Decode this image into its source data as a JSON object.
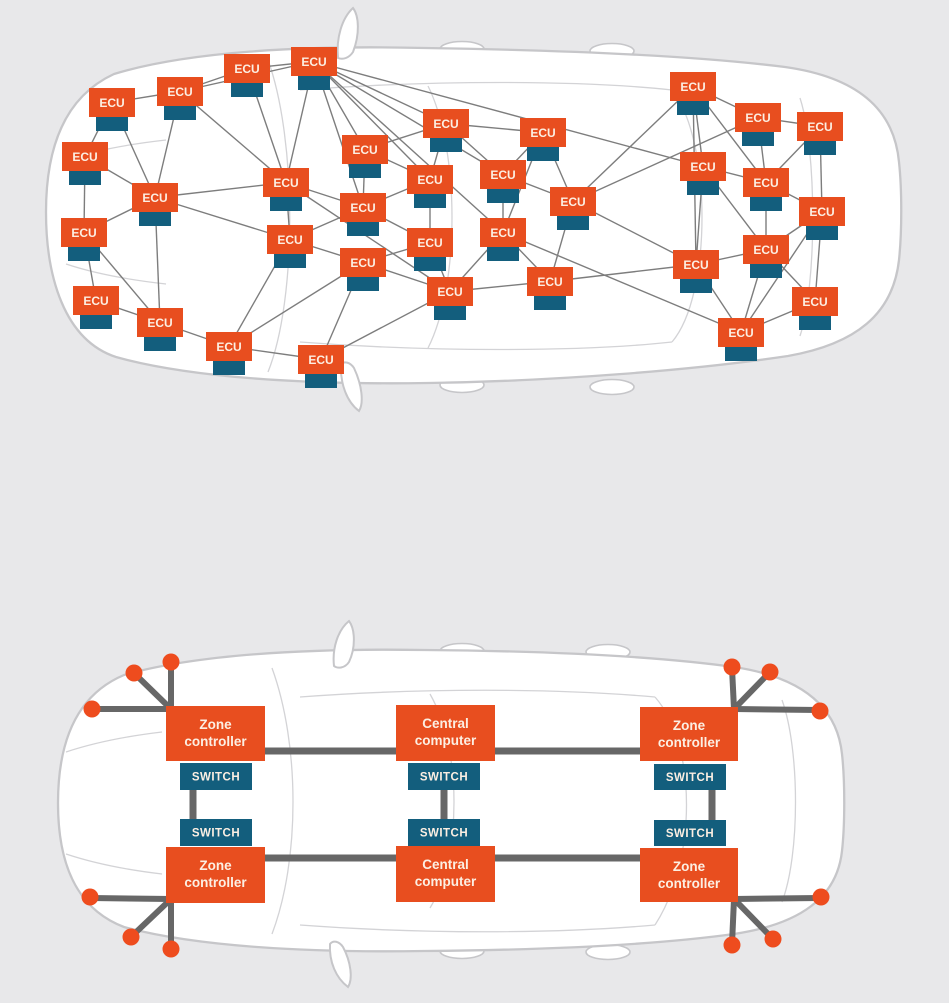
{
  "colors": {
    "background": "#e8e8ea",
    "box_orange": "#e84e1f",
    "box_teal": "#135e7d",
    "dot_orange": "#ee4c1e",
    "mesh_line": "#7d7d7d",
    "trunk_line": "#676767",
    "car_fill": "#ffffff",
    "car_stroke": "#c6c6c9",
    "car_inner_line": "#d3d3d6",
    "label_text": "#fcefe3"
  },
  "legacy_diagram": {
    "node_label": "ECU",
    "node_count": 35,
    "nodes": [
      {
        "x": 224,
        "y": 54
      },
      {
        "x": 291,
        "y": 47
      },
      {
        "x": 89,
        "y": 88
      },
      {
        "x": 157,
        "y": 77
      },
      {
        "x": 670,
        "y": 72
      },
      {
        "x": 423,
        "y": 109
      },
      {
        "x": 520,
        "y": 118
      },
      {
        "x": 735,
        "y": 103
      },
      {
        "x": 797,
        "y": 112
      },
      {
        "x": 62,
        "y": 142
      },
      {
        "x": 680,
        "y": 152
      },
      {
        "x": 743,
        "y": 168
      },
      {
        "x": 132,
        "y": 183
      },
      {
        "x": 263,
        "y": 168
      },
      {
        "x": 342,
        "y": 135
      },
      {
        "x": 407,
        "y": 165
      },
      {
        "x": 480,
        "y": 160
      },
      {
        "x": 550,
        "y": 187
      },
      {
        "x": 799,
        "y": 197
      },
      {
        "x": 61,
        "y": 218
      },
      {
        "x": 267,
        "y": 225
      },
      {
        "x": 340,
        "y": 193
      },
      {
        "x": 407,
        "y": 228
      },
      {
        "x": 480,
        "y": 218
      },
      {
        "x": 743,
        "y": 235
      },
      {
        "x": 340,
        "y": 248
      },
      {
        "x": 673,
        "y": 250
      },
      {
        "x": 73,
        "y": 286
      },
      {
        "x": 137,
        "y": 308
      },
      {
        "x": 427,
        "y": 277
      },
      {
        "x": 527,
        "y": 267
      },
      {
        "x": 792,
        "y": 287
      },
      {
        "x": 718,
        "y": 318
      },
      {
        "x": 206,
        "y": 332
      },
      {
        "x": 298,
        "y": 345
      }
    ],
    "edges": [
      [
        0,
        1
      ],
      [
        0,
        3
      ],
      [
        0,
        13
      ],
      [
        1,
        3
      ],
      [
        1,
        5
      ],
      [
        1,
        13
      ],
      [
        1,
        14
      ],
      [
        1,
        15
      ],
      [
        1,
        16
      ],
      [
        1,
        21
      ],
      [
        1,
        10
      ],
      [
        1,
        23
      ],
      [
        2,
        3
      ],
      [
        2,
        9
      ],
      [
        2,
        12
      ],
      [
        3,
        12
      ],
      [
        3,
        13
      ],
      [
        4,
        7
      ],
      [
        4,
        10
      ],
      [
        4,
        11
      ],
      [
        4,
        17
      ],
      [
        4,
        26
      ],
      [
        5,
        6
      ],
      [
        5,
        14
      ],
      [
        5,
        15
      ],
      [
        5,
        16
      ],
      [
        6,
        16
      ],
      [
        6,
        17
      ],
      [
        6,
        23
      ],
      [
        7,
        8
      ],
      [
        7,
        11
      ],
      [
        7,
        17
      ],
      [
        8,
        11
      ],
      [
        8,
        18
      ],
      [
        9,
        12
      ],
      [
        9,
        19
      ],
      [
        10,
        11
      ],
      [
        10,
        24
      ],
      [
        10,
        26
      ],
      [
        11,
        18
      ],
      [
        11,
        24
      ],
      [
        12,
        13
      ],
      [
        12,
        19
      ],
      [
        12,
        20
      ],
      [
        12,
        28
      ],
      [
        13,
        20
      ],
      [
        13,
        21
      ],
      [
        13,
        29
      ],
      [
        14,
        15
      ],
      [
        14,
        21
      ],
      [
        15,
        21
      ],
      [
        15,
        22
      ],
      [
        16,
        17
      ],
      [
        16,
        23
      ],
      [
        17,
        26
      ],
      [
        17,
        30
      ],
      [
        18,
        24
      ],
      [
        18,
        31
      ],
      [
        18,
        32
      ],
      [
        19,
        27
      ],
      [
        19,
        28
      ],
      [
        20,
        21
      ],
      [
        20,
        25
      ],
      [
        20,
        33
      ],
      [
        21,
        22
      ],
      [
        22,
        25
      ],
      [
        22,
        29
      ],
      [
        23,
        29
      ],
      [
        23,
        30
      ],
      [
        23,
        32
      ],
      [
        24,
        26
      ],
      [
        24,
        31
      ],
      [
        24,
        32
      ],
      [
        25,
        29
      ],
      [
        25,
        33
      ],
      [
        25,
        34
      ],
      [
        26,
        30
      ],
      [
        26,
        32
      ],
      [
        27,
        28
      ],
      [
        28,
        33
      ],
      [
        29,
        30
      ],
      [
        29,
        34
      ],
      [
        31,
        32
      ],
      [
        33,
        34
      ]
    ]
  },
  "zonal_diagram": {
    "labels": {
      "zone_controller": [
        "Zone",
        "controller"
      ],
      "central_computer": [
        "Central",
        "computer"
      ],
      "switch": "SWITCH"
    },
    "devices": [
      {
        "id": "zone-controller-front-left",
        "type": "zone_controller",
        "x": 166,
        "y": 706,
        "w": 99,
        "h": 55
      },
      {
        "id": "central-computer-front",
        "type": "central_computer",
        "x": 396,
        "y": 705,
        "w": 99,
        "h": 56
      },
      {
        "id": "zone-controller-front-right",
        "type": "zone_controller",
        "x": 640,
        "y": 707,
        "w": 98,
        "h": 54
      },
      {
        "id": "zone-controller-rear-left",
        "type": "zone_controller",
        "x": 166,
        "y": 847,
        "w": 99,
        "h": 56
      },
      {
        "id": "central-computer-rear",
        "type": "central_computer",
        "x": 396,
        "y": 846,
        "w": 99,
        "h": 56
      },
      {
        "id": "zone-controller-rear-right",
        "type": "zone_controller",
        "x": 640,
        "y": 848,
        "w": 98,
        "h": 54
      }
    ],
    "switches": [
      {
        "x": 180,
        "y": 763,
        "w": 72,
        "h": 27
      },
      {
        "x": 180,
        "y": 819,
        "w": 72,
        "h": 27
      },
      {
        "x": 408,
        "y": 763,
        "w": 72,
        "h": 27
      },
      {
        "x": 408,
        "y": 819,
        "w": 72,
        "h": 27
      },
      {
        "x": 654,
        "y": 764,
        "w": 72,
        "h": 26
      },
      {
        "x": 654,
        "y": 820,
        "w": 72,
        "h": 26
      }
    ],
    "trunk_lines": [
      {
        "x1": 215,
        "y1": 751,
        "x2": 690,
        "y2": 751
      },
      {
        "x1": 215,
        "y1": 858,
        "x2": 690,
        "y2": 858
      },
      {
        "x1": 193,
        "y1": 789,
        "x2": 193,
        "y2": 820
      },
      {
        "x1": 444,
        "y1": 789,
        "x2": 444,
        "y2": 820
      },
      {
        "x1": 712,
        "y1": 789,
        "x2": 712,
        "y2": 820
      }
    ],
    "sensor_links": [
      {
        "x1": 171,
        "y1": 709,
        "x2": 171,
        "y2": 663
      },
      {
        "x1": 171,
        "y1": 709,
        "x2": 136,
        "y2": 675
      },
      {
        "x1": 171,
        "y1": 709,
        "x2": 93,
        "y2": 709
      },
      {
        "x1": 171,
        "y1": 899,
        "x2": 91,
        "y2": 898
      },
      {
        "x1": 171,
        "y1": 899,
        "x2": 132,
        "y2": 936
      },
      {
        "x1": 171,
        "y1": 899,
        "x2": 171,
        "y2": 948
      },
      {
        "x1": 734,
        "y1": 709,
        "x2": 732,
        "y2": 668
      },
      {
        "x1": 734,
        "y1": 709,
        "x2": 769,
        "y2": 673
      },
      {
        "x1": 734,
        "y1": 709,
        "x2": 819,
        "y2": 710
      },
      {
        "x1": 734,
        "y1": 899,
        "x2": 820,
        "y2": 898
      },
      {
        "x1": 734,
        "y1": 899,
        "x2": 772,
        "y2": 938
      },
      {
        "x1": 734,
        "y1": 899,
        "x2": 732,
        "y2": 944
      }
    ],
    "dots": [
      {
        "x": 171,
        "y": 662
      },
      {
        "x": 134,
        "y": 673
      },
      {
        "x": 92,
        "y": 709
      },
      {
        "x": 90,
        "y": 897
      },
      {
        "x": 131,
        "y": 937
      },
      {
        "x": 171,
        "y": 949
      },
      {
        "x": 732,
        "y": 667
      },
      {
        "x": 770,
        "y": 672
      },
      {
        "x": 820,
        "y": 711
      },
      {
        "x": 821,
        "y": 897
      },
      {
        "x": 773,
        "y": 939
      },
      {
        "x": 732,
        "y": 945
      }
    ]
  }
}
